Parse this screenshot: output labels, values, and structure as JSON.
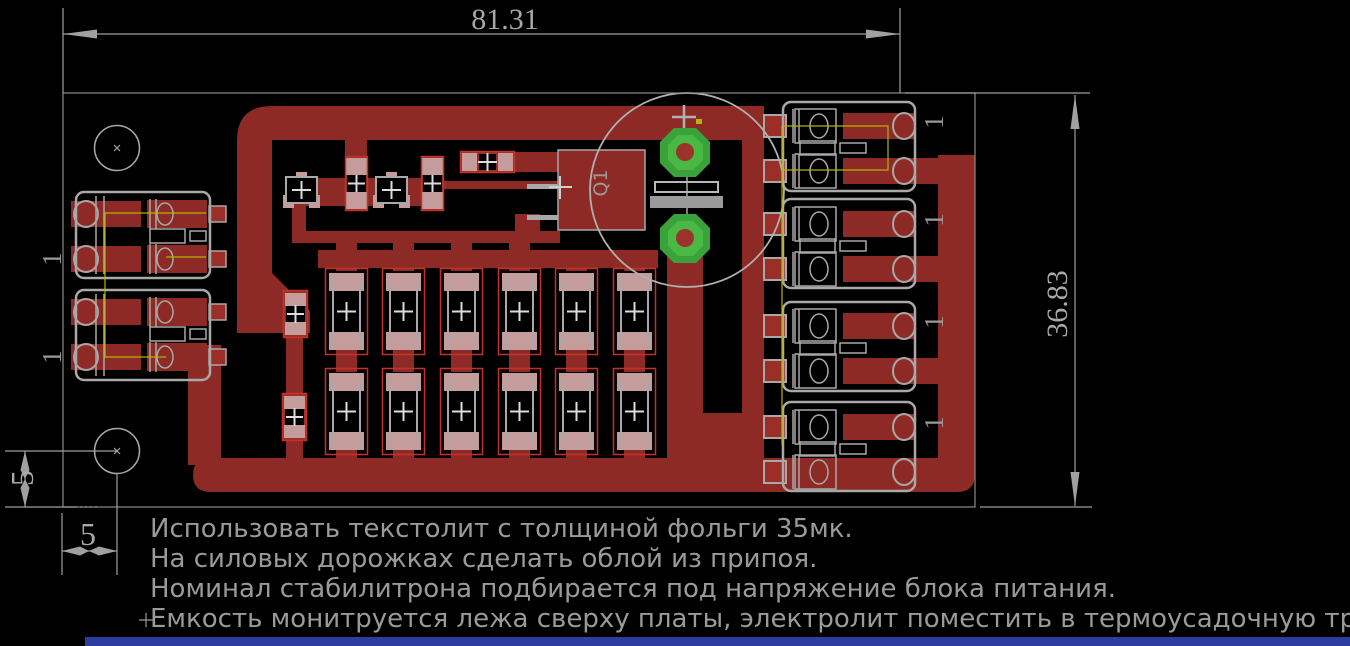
{
  "app": {
    "view": "pcb-board-layout",
    "background": "#000000"
  },
  "dimensions": {
    "board_width": "81.31",
    "board_height": "36.83",
    "hole_offset_vertical": "5",
    "hole_offset_horizontal": "5"
  },
  "notes": {
    "line1": "Использовать текстолит с толщиной фольги 35мк.",
    "line2": "На силовых дорожках сделать облой из припоя.",
    "line3": "Номинал стабилитрона подбирается под напряжение блока питания.",
    "line4": "Емкость монитруется лежа сверху платы, электролит поместить в термоусадочную трубку."
  },
  "labels": {
    "transistor_ref": "Q1",
    "pin_one": "1"
  },
  "board": {
    "mounting_holes": 2,
    "diode_array": {
      "rows": 2,
      "columns": 6
    },
    "left_connector_groups": 2,
    "right_connector_groups": 4,
    "electrolytic_capacitor_pads": 2
  },
  "palette": {
    "copper": "#8e2a25",
    "copper_bright": "#9b2f28",
    "component_outline": "#c5302a",
    "pad_pink": "#c49c9c",
    "pad_green": "#3aa23a",
    "pad_green_light": "#4ab944",
    "drill_red": "#9c322c",
    "silkscreen": "#a8a8a8",
    "dimension_gray": "#a0a0a0",
    "airwire_yellow": "#b5b500",
    "bottom_bar_blue": "#2c3da0"
  }
}
